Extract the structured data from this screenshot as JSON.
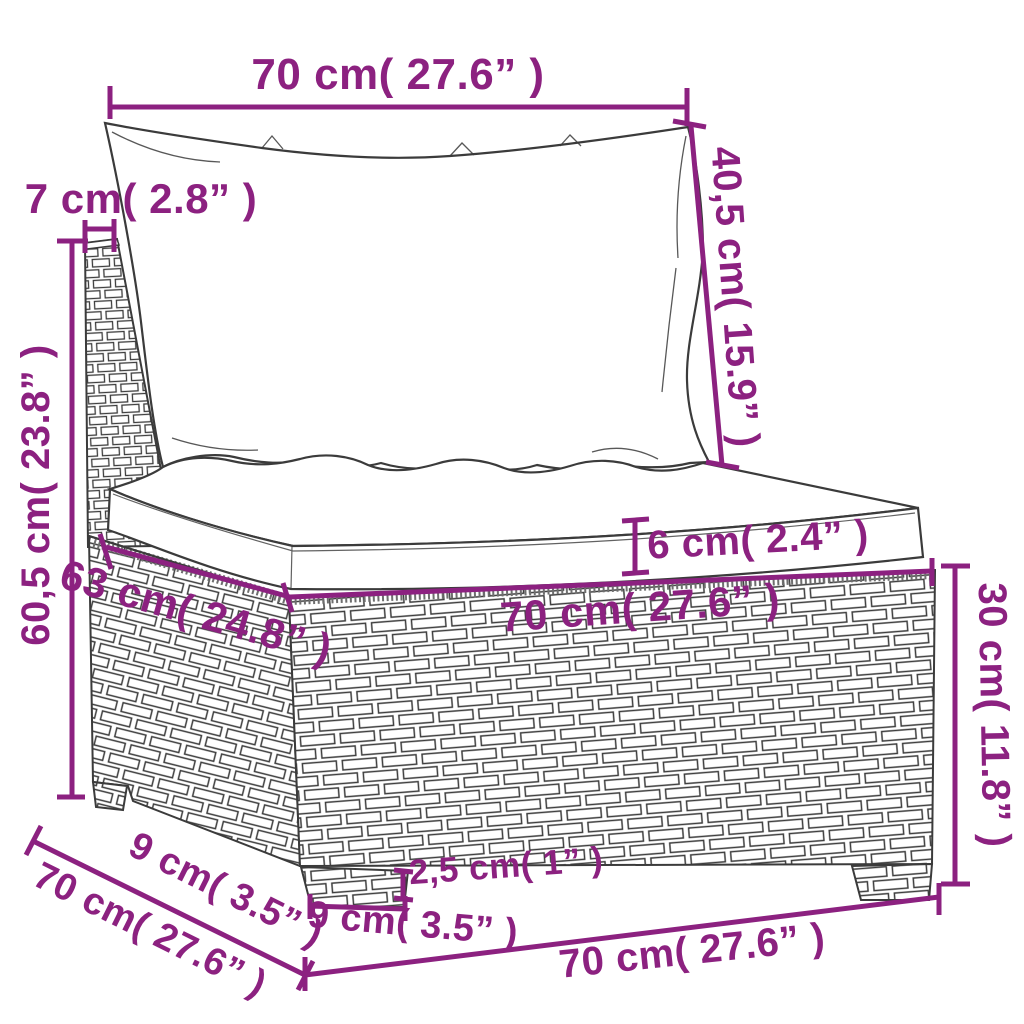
{
  "figure": {
    "type": "product dimension diagram",
    "product": "poly rattan sectional sofa seat with cushions",
    "accent_color": "#8C2180",
    "line_color": "#3B3B3B",
    "background_color": "#FFFFFF"
  },
  "dimensions": {
    "back_width": "70 cm( 27.6” )",
    "back_thickness": "7 cm( 2.8” )",
    "back_cushion_height": "40,5 cm( 15.9” )",
    "overall_height": "60,5 cm( 23.8” )",
    "seat_cushion_thickness": "6 cm( 2.4” )",
    "seat_width": "70 cm( 27.6” )",
    "seat_depth": "63 cm( 24.8” )",
    "base_height": "30 cm( 11.8” )",
    "foot_inset_depth": "9 cm( 3.5” )",
    "base_depth": "70 cm( 27.6” )",
    "foot_height": "2,5 cm( 1” )",
    "foot_width": "9 cm( 3.5” )",
    "base_width": "70 cm( 27.6” )"
  }
}
